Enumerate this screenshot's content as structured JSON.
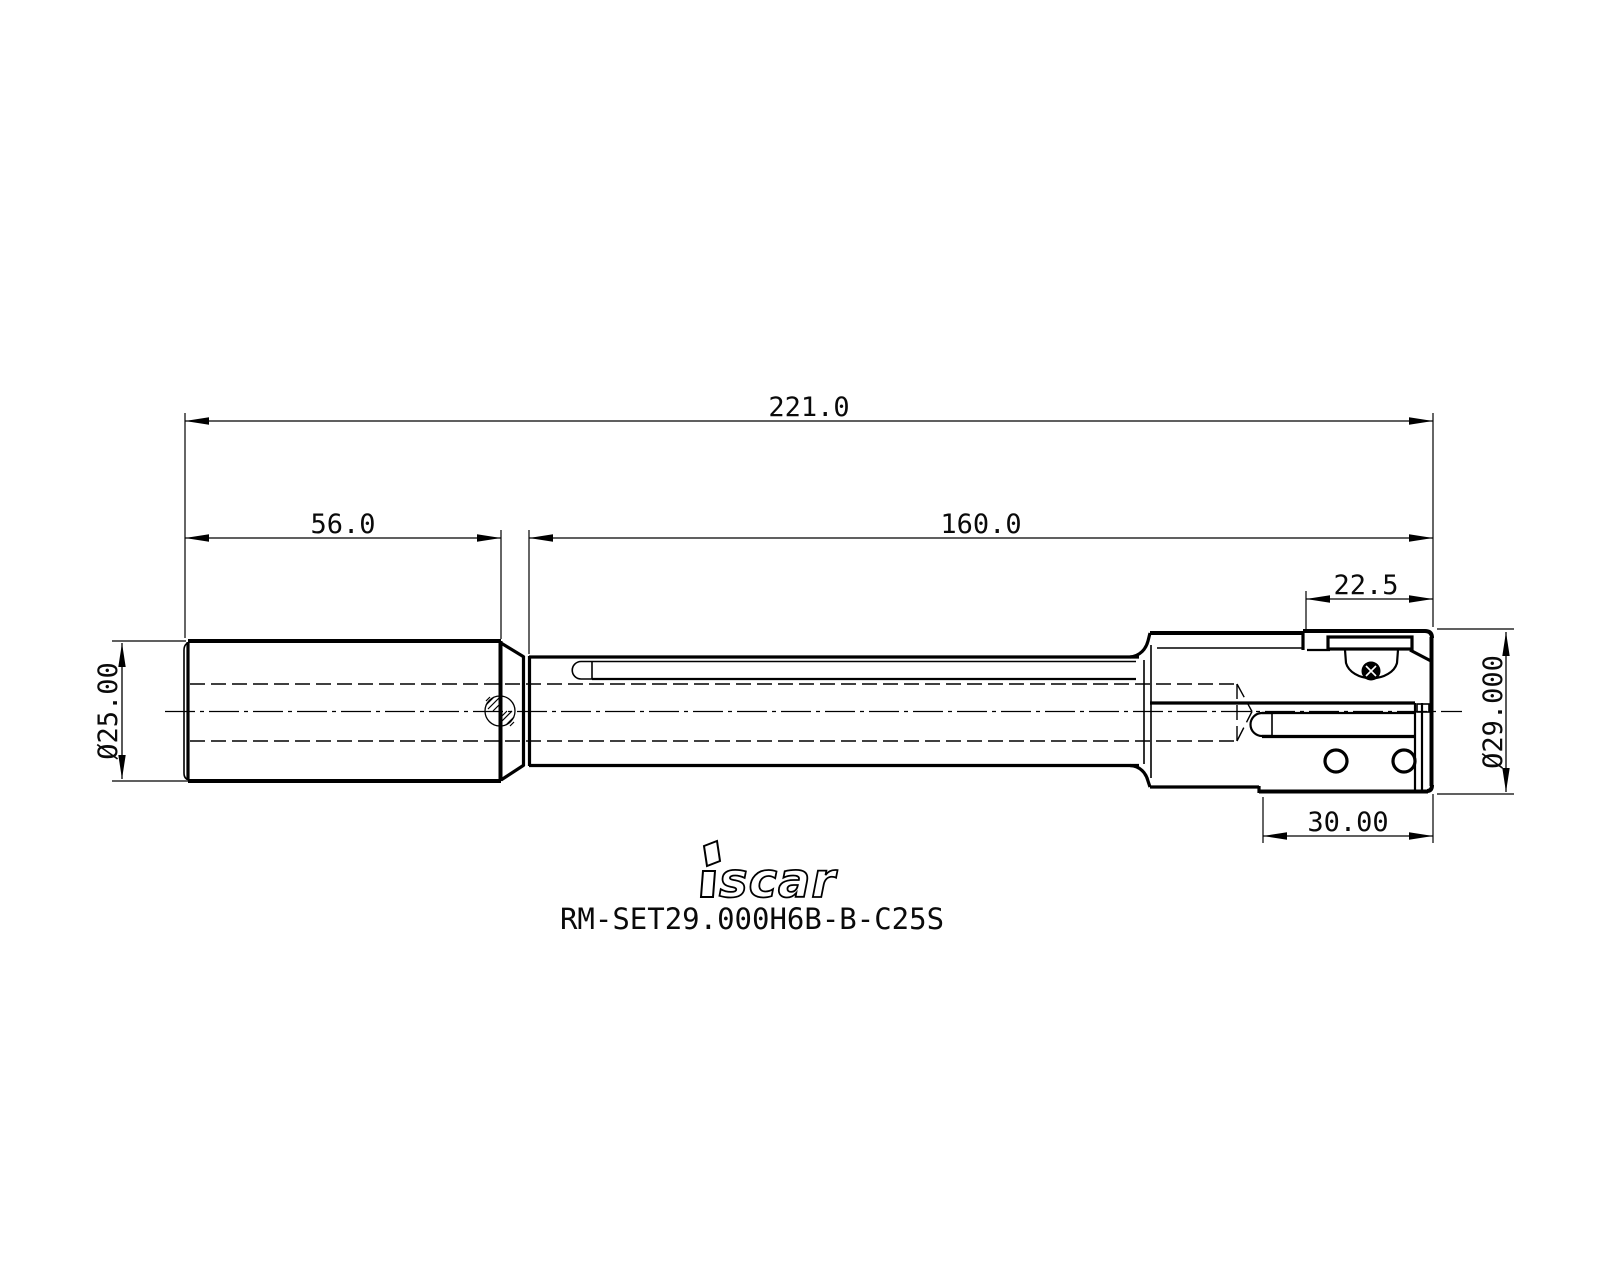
{
  "page": {
    "background": "#ffffff",
    "line_color": "#000000"
  },
  "part": {
    "part_number": "RM-SET29.000H6B-B-C25S",
    "brand": "iscar",
    "brand_tail": "scar"
  },
  "dims": {
    "overall": "221.0",
    "shank_length": "56.0",
    "body_length": "160.0",
    "head_top": "22.5",
    "head_bottom": "30.00",
    "shank_diameter": "Ø25.00",
    "head_diameter": "Ø29.000"
  }
}
